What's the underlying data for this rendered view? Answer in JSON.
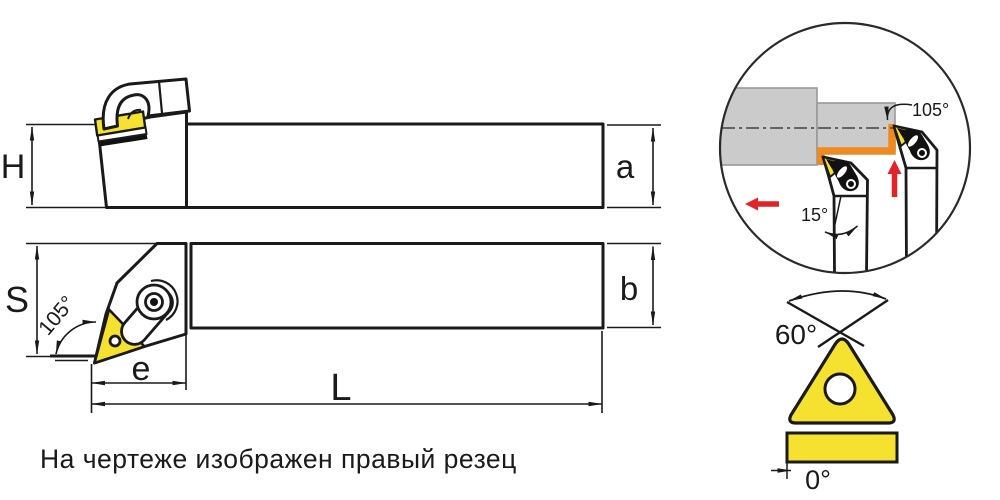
{
  "note": "На чертеже изображен правый резец",
  "dims": {
    "H": "H",
    "a": "a",
    "S": "S",
    "b": "b",
    "e": "e",
    "L": "L"
  },
  "angles": {
    "top_view_lead": "105°",
    "detail_lead": "105°",
    "detail_back": "15°",
    "insert_tip": "60°",
    "insert_clearance": "0°"
  },
  "colors": {
    "insert_yellow": "#F5E12F",
    "cut_path_orange": "#EE8A1F",
    "feed_arrow_red": "#E02428",
    "workpiece_gray": "#CBCBCB",
    "outline_black": "#1A1A1A"
  }
}
